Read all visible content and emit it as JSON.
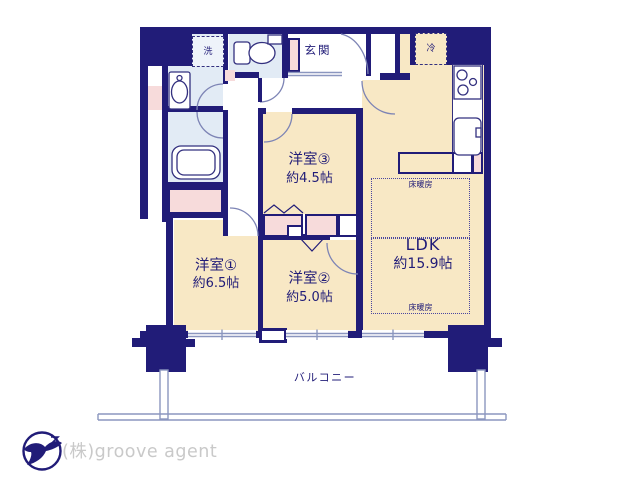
{
  "plan": {
    "rooms": {
      "room1": {
        "name": "洋室①",
        "size": "約6.5帖"
      },
      "room2": {
        "name": "洋室②",
        "size": "約5.0帖"
      },
      "room3": {
        "name": "洋室③",
        "size": "約4.5帖"
      },
      "ldk": {
        "name": "LDK",
        "size": "約15.9帖"
      }
    },
    "labels": {
      "entrance": "玄関",
      "washer": "洗",
      "fridge": "冷",
      "floor_heating": "床暖房",
      "balcony": "バルコニー"
    }
  },
  "branding": {
    "company": "(株)groove agent"
  },
  "colors": {
    "wall": "#211c78",
    "floor": "#f8e8c5",
    "wet_area": "#e2ebf5",
    "closet": "#f7dbdb",
    "thin_line": "#8b96bf",
    "logo_text": "#c9c9c9"
  }
}
